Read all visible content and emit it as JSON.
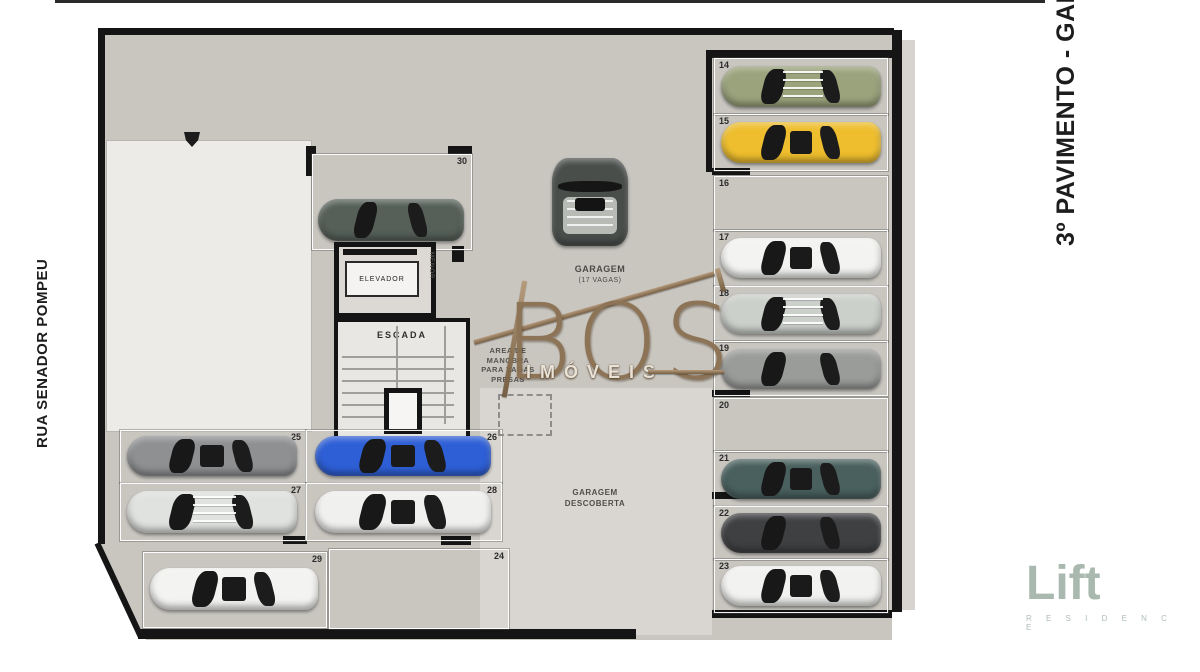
{
  "labels": {
    "street": "RUA SENADOR POMPEU",
    "floor_title": "3º PAVIMENTO - GARAGEM",
    "garage": "GARAGEM",
    "garage_capacity": "(17 VAGAS)",
    "maneuver_line1": "AREA DE",
    "maneuver_line2": "MANOBRA",
    "maneuver_line3": "PARA VAGAS",
    "maneuver_line4": "PRESAS",
    "uncovered_line1": "GARAGEM",
    "uncovered_line2": "DESCOBERTA",
    "elevator": "ELEVADOR",
    "elevator_shaft": "MENOR",
    "stairs": "ESCADA"
  },
  "watermark": {
    "brand": "BOS",
    "subtitle": "IMÓVEIS",
    "color": "#8a6e4e"
  },
  "logo": {
    "name": "Lift",
    "subtitle": "R E S I D E N C E",
    "color": "#9bada3"
  },
  "colors": {
    "plan_gray": "#c9c6c0",
    "plan_light": "#d9d6d1",
    "building_white": "#edebe7",
    "line_black": "#151515",
    "watermark_bronze": "#8a6e4e",
    "logo_sage": "#9bada3"
  },
  "spots": {
    "right_column": [
      {
        "number": "14",
        "occupied": true,
        "car_color": "#9aa37c",
        "roof_rack": true
      },
      {
        "number": "15",
        "occupied": true,
        "car_color": "#eebe2e",
        "roof_rack": false
      },
      {
        "number": "16",
        "occupied": false
      },
      {
        "number": "17",
        "occupied": true,
        "car_color": "#f3f3f1",
        "roof_rack": false
      },
      {
        "number": "18",
        "occupied": true,
        "car_color": "#ccd0cb",
        "roof_rack": true
      },
      {
        "number": "19",
        "occupied": true,
        "car_color": "#9a9c9a",
        "roof_rack": false
      },
      {
        "number": "20",
        "occupied": false
      },
      {
        "number": "21",
        "occupied": true,
        "car_color": "#49605e",
        "roof_rack": false
      },
      {
        "number": "22",
        "occupied": true,
        "car_color": "#3f4042",
        "roof_rack": false
      },
      {
        "number": "23",
        "occupied": true,
        "car_color": "#f2f2f0",
        "roof_rack": false
      }
    ],
    "top_center": {
      "number": "30",
      "occupied": true,
      "car_color": "#566059"
    },
    "middle_grid": [
      {
        "number": "25",
        "occupied": true,
        "car_color": "#8e9092",
        "roof_rack": false
      },
      {
        "number": "26",
        "occupied": true,
        "car_color": "#2e5fd6",
        "roof_rack": false
      },
      {
        "number": "27",
        "occupied": true,
        "car_color": "#e0e2df",
        "roof_rack": true
      },
      {
        "number": "28",
        "occupied": true,
        "car_color": "#f0f1ef",
        "roof_rack": false
      }
    ],
    "bottom_row": [
      {
        "number": "29",
        "occupied": true,
        "car_color": "#f3f3f1"
      },
      {
        "number": "24",
        "occupied": false
      }
    ],
    "maneuver_car": {
      "occupied": true,
      "car_color": "#4a4e4b"
    }
  }
}
